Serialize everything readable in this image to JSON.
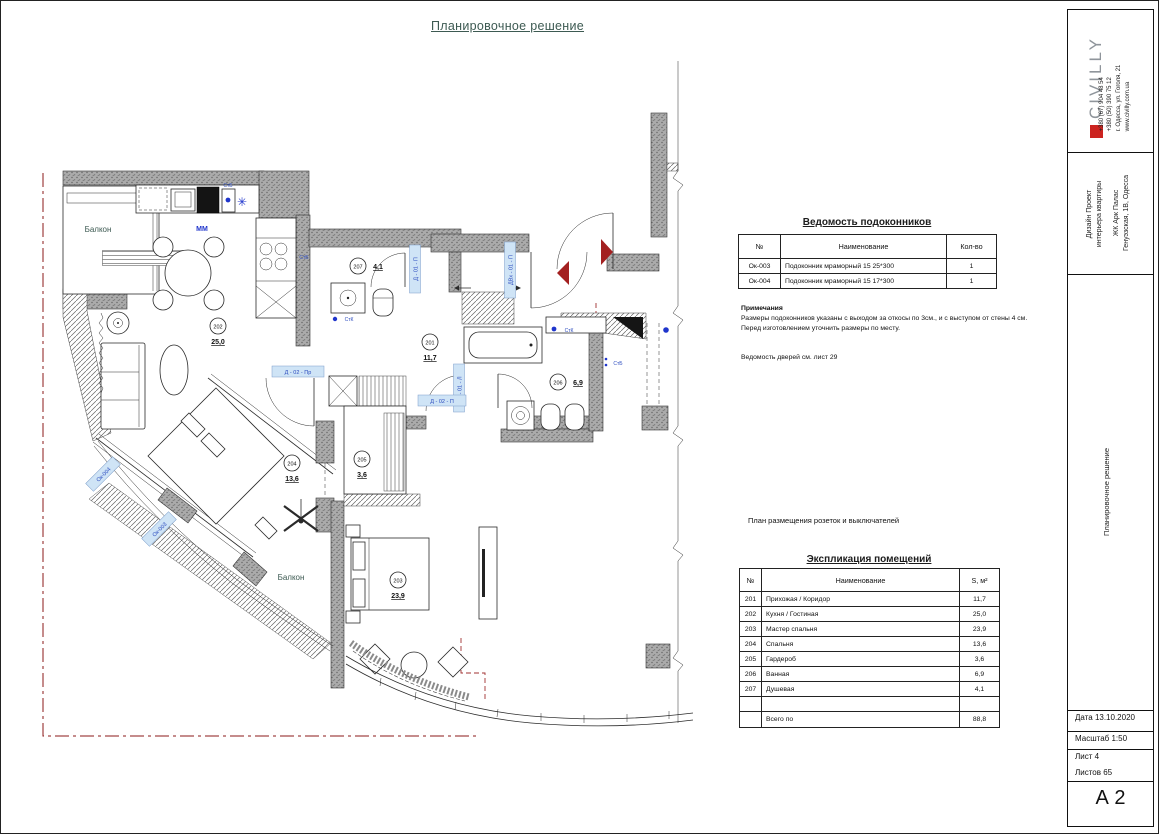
{
  "sheet": {
    "title": "Планировочное решение"
  },
  "plan": {
    "balcony_top": "Балкон",
    "balcony_bottom": "Балкон",
    "rooms": {
      "r201": {
        "num": "201",
        "area": "11,7"
      },
      "r202": {
        "num": "202",
        "area": "25,0"
      },
      "r203": {
        "num": "203",
        "area": "23,9"
      },
      "r204": {
        "num": "204",
        "area": "13,6"
      },
      "r205": {
        "num": "205",
        "area": "3,6"
      },
      "r206": {
        "num": "206",
        "area": "6,9"
      },
      "r207": {
        "num": "207",
        "area": "4,1"
      }
    },
    "tags": {
      "mm": "MM",
      "stb": "СтБ",
      "stk": "СтК",
      "door_shower": "Д - 01 - П",
      "door_entry": "ДВх - 01 - П",
      "door_bath": "Д - 01 - Л",
      "door_master": "Д - 02 - П",
      "door_bedroom": "Д - 02 - Пр",
      "window_top": "Ок-004",
      "window_bottom": "Ок-003"
    },
    "icons": {
      "snowflake": "✳"
    }
  },
  "sill_table": {
    "title": "Ведомость подоконников",
    "columns": [
      "№",
      "Наименование",
      "Кол-во"
    ],
    "rows": [
      [
        "Ок-003",
        "Подоконник мраморный 15 25*300",
        "1"
      ],
      [
        "Ок-004",
        "Подоконник мраморный 15 17*300",
        "1"
      ]
    ],
    "notes_title": "Примечания",
    "note1": "Размеры подоконников указаны с выходом за откосы по 3см., и с выступом от стены 4 см.",
    "note2": "Перед изготовлением уточнить размеры по месту.",
    "doors_note": "Ведомость дверей см. лист 29"
  },
  "sockets_note": "План размещения розеток и выключателей",
  "explication_table": {
    "title": "Экспликация помещений",
    "columns": [
      "№",
      "Наименование",
      "S, м²"
    ],
    "rows": [
      [
        "201",
        "Прихожая / Коридор",
        "11,7"
      ],
      [
        "202",
        "Кухня / Гостиная",
        "25,0"
      ],
      [
        "203",
        "Мастер спальня",
        "23,9"
      ],
      [
        "204",
        "Спальня",
        "13,6"
      ],
      [
        "205",
        "Гардероб",
        "3,6"
      ],
      [
        "206",
        "Ванная",
        "6,9"
      ],
      [
        "207",
        "Душевая",
        "4,1"
      ],
      [
        "",
        "",
        ""
      ]
    ],
    "total_label": "Всего по",
    "total_value": "88,8"
  },
  "titleblock": {
    "brand": "CIVILLY",
    "contacts": [
      "+380 (67) 904 48 54",
      "+380 (50) 390 75 12",
      "г. Одесса, ул. Гоголя, 21",
      "www.civilly.com.ua"
    ],
    "project_line1": "Дизайн Проект",
    "project_line2": "интерьера квартиры",
    "addr_line1": "ЖК Арк Палас",
    "addr_line2": "Генуэзская, 1В, Одесса",
    "sheet_name": "Планировочное решение",
    "date_label": "Дата 13.10.2020",
    "scale_label": "Масштаб 1:50",
    "sheet_label": "Лист 4",
    "sheets_label": "Листов 65",
    "format": "А 2"
  },
  "colors": {
    "accent_red": "#cc2420",
    "tag_blue": "#2b4bbf",
    "boundary_red": "#8b1a1a",
    "title_green": "#3d5a52"
  }
}
